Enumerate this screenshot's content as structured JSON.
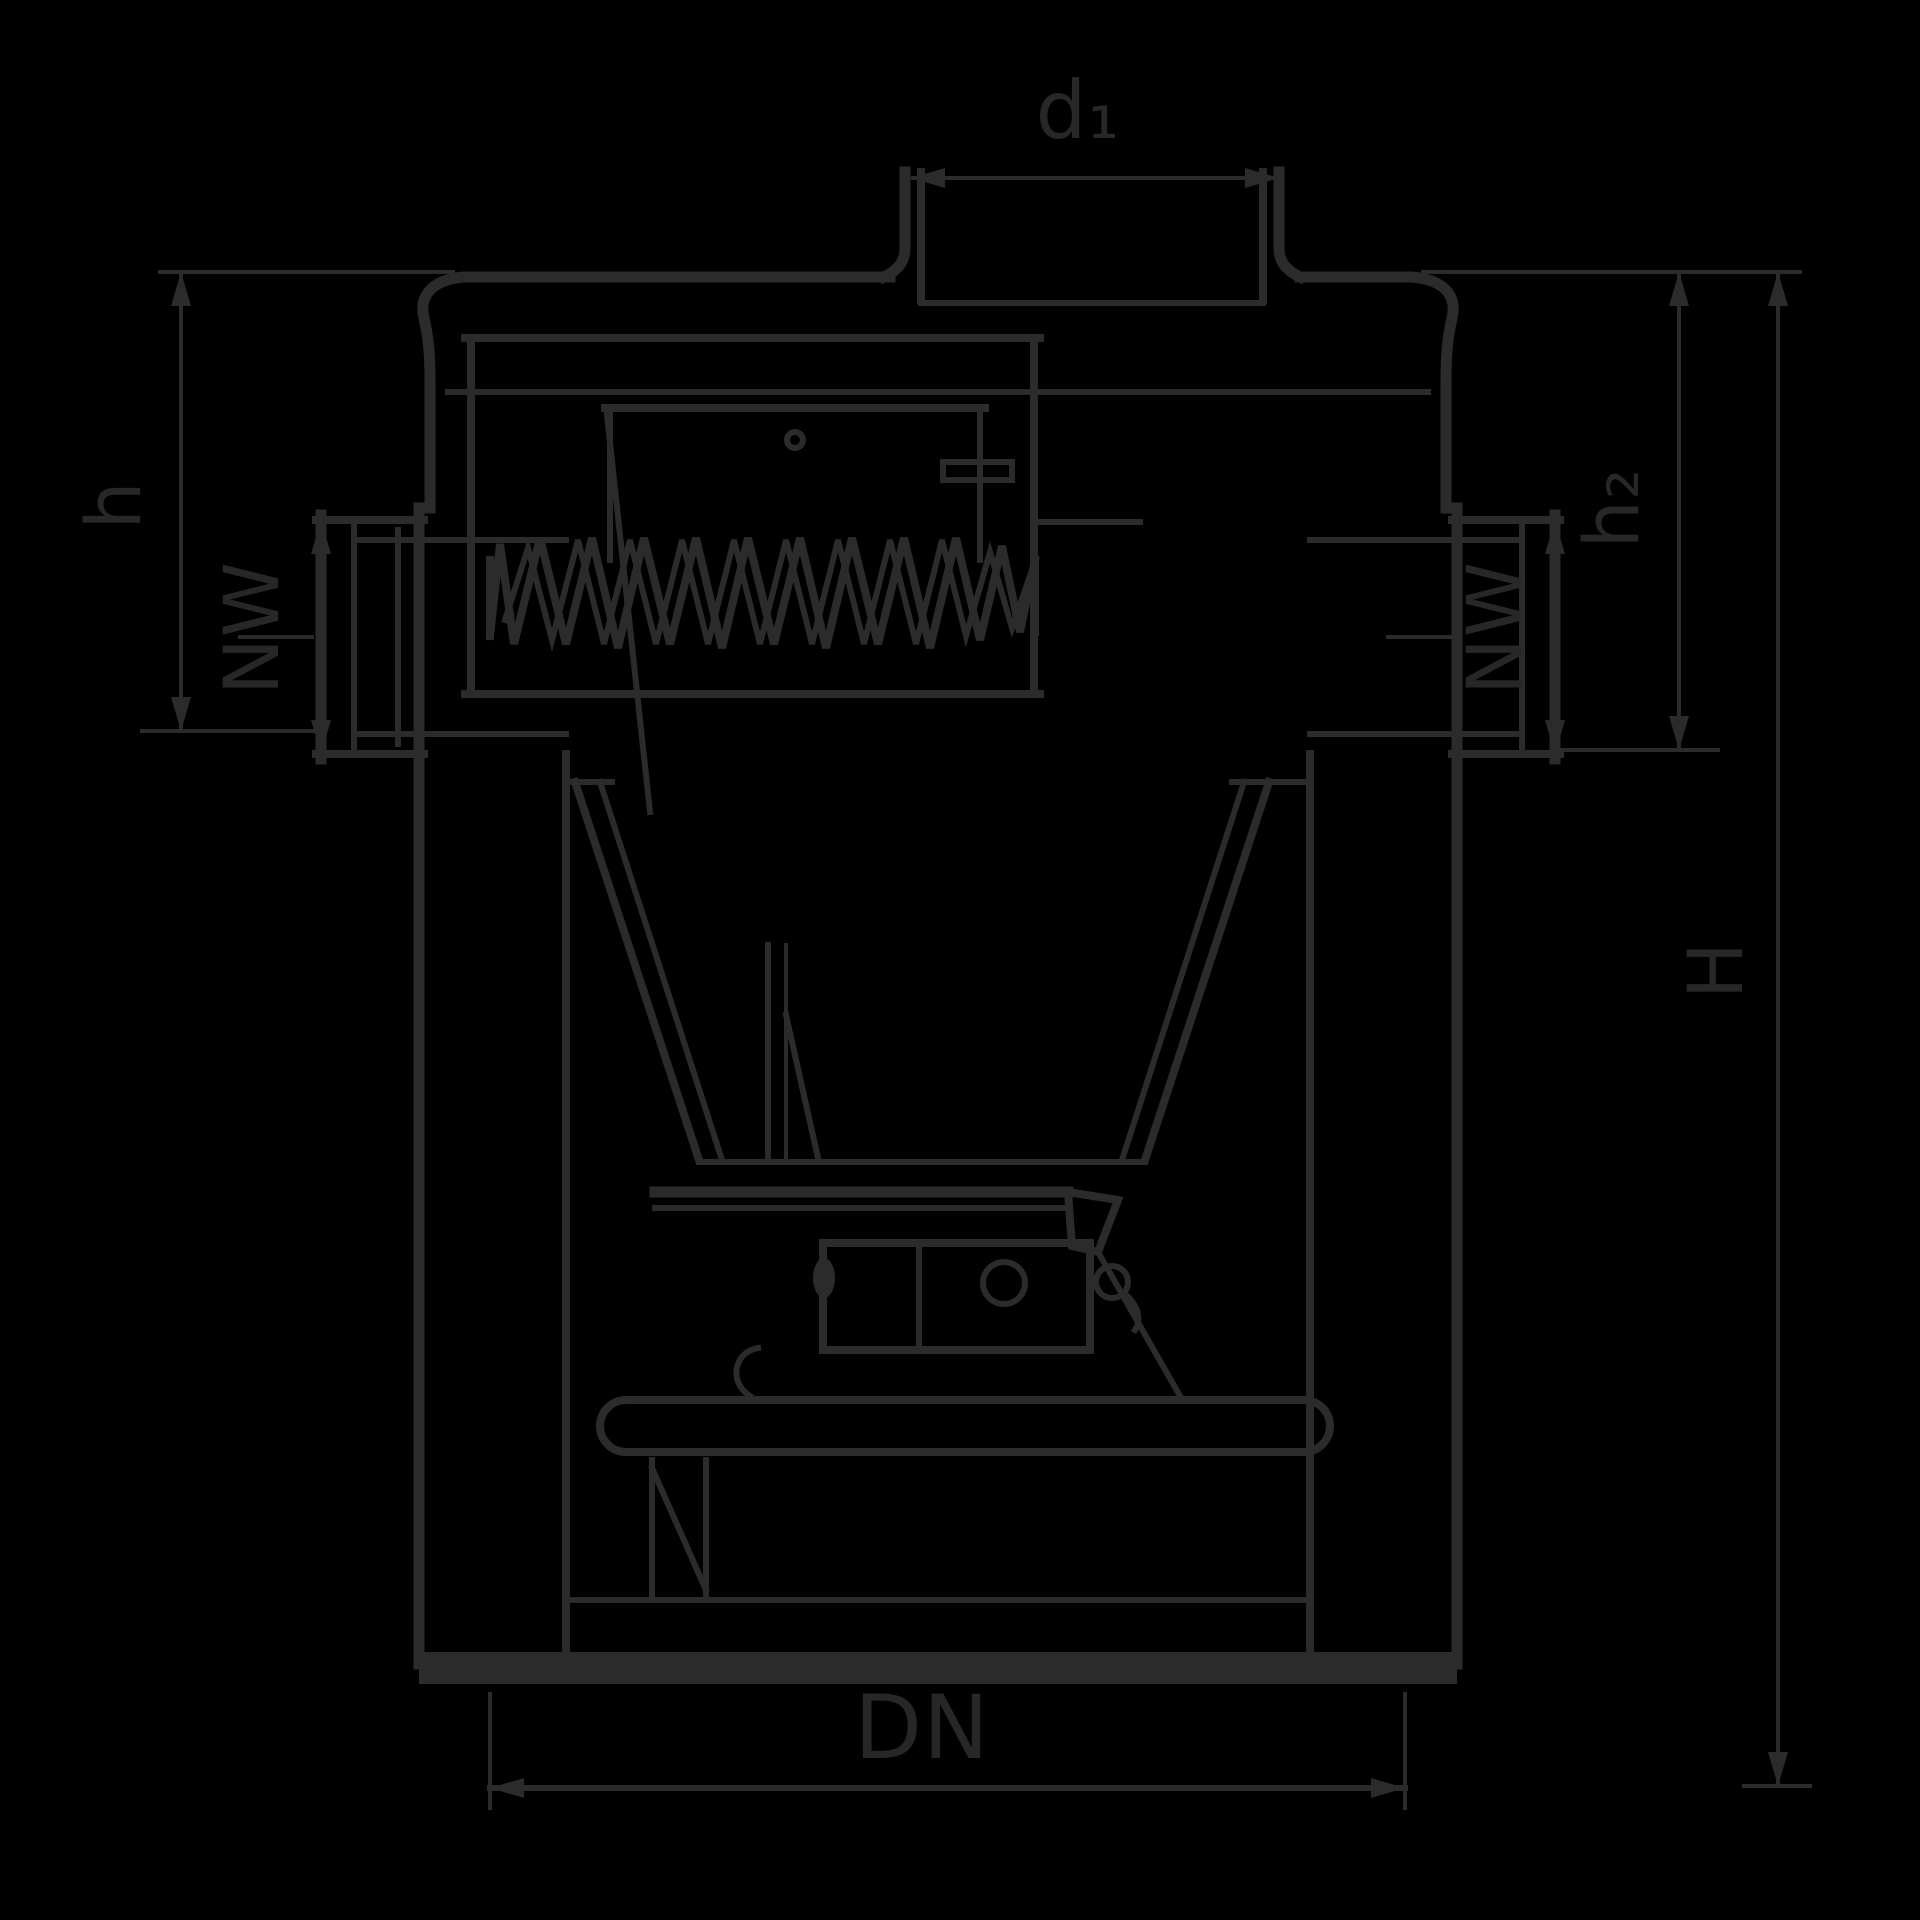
{
  "title": "Backwater valve cross-section technical drawing",
  "colors": {
    "background": "#000000",
    "line": "#2b2b2b",
    "text": "#272727"
  },
  "labels": {
    "top_diameter": "d₁",
    "inlet_height": "h",
    "inlet_nominal_width": "NW",
    "outlet_nominal_width": "NW",
    "outlet_height": "h₂",
    "total_height": "H",
    "bottom_outlet": "DN"
  }
}
